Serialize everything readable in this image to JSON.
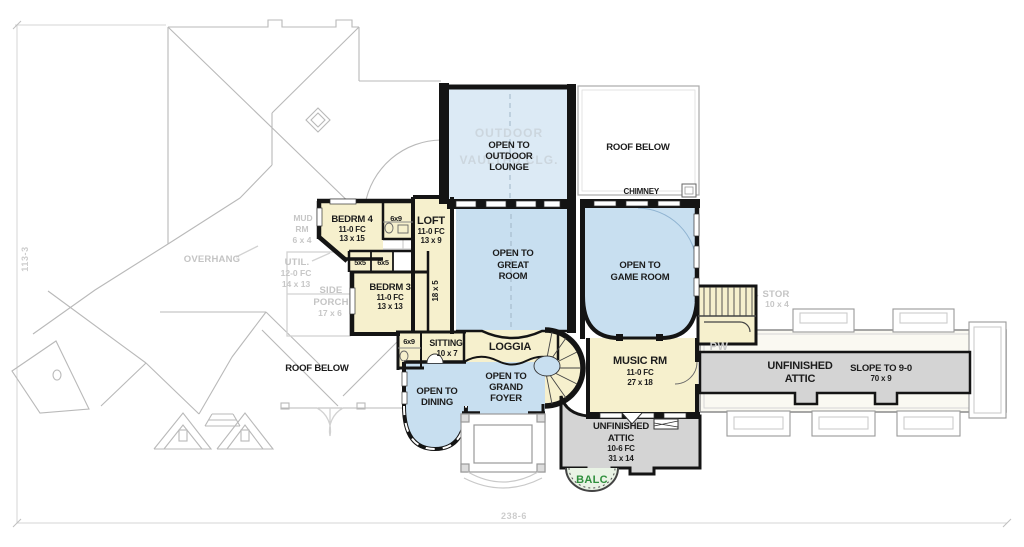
{
  "plan": {
    "dim_height": "113-3",
    "dim_width": "238-6",
    "watermark": {
      "l1": "OUTDOOR",
      "l2": "VAULTED CLG."
    },
    "open": {
      "lounge": {
        "l1": "OPEN TO",
        "l2": "OUTDOOR",
        "l3": "LOUNGE"
      },
      "great": {
        "l1": "OPEN TO",
        "l2": "GREAT",
        "l3": "ROOM"
      },
      "game": {
        "l1": "OPEN TO",
        "l2": "GAME ROOM"
      },
      "dining": {
        "l1": "OPEN TO",
        "l2": "DINING"
      },
      "foyer": {
        "l1": "OPEN TO",
        "l2": "GRAND",
        "l3": "FOYER"
      }
    },
    "rooms": {
      "bedrm4": {
        "name": "BEDRM 4",
        "fc": "11-0 FC",
        "size": "13 x 15"
      },
      "loft": {
        "name": "LOFT",
        "fc": "11-0 FC",
        "size": "13 x 9"
      },
      "bedrm3": {
        "name": "BEDRM 3",
        "fc": "11-0 FC",
        "size": "13 x 13"
      },
      "sitting": {
        "name": "SITTING",
        "size": "10 x 7"
      },
      "loggia": {
        "name": "LOGGIA"
      },
      "music": {
        "name": "MUSIC RM",
        "fc": "11-0 FC",
        "size": "27 x 18"
      },
      "bath_a": {
        "size": "6x9"
      },
      "closet_a": {
        "size": "5x5"
      },
      "closet_b": {
        "size": "6x5"
      },
      "bath_b": {
        "size": "6x9"
      },
      "hall": {
        "size": "18 x 5"
      }
    },
    "roof": {
      "top": "ROOF BELOW",
      "chimney": "CHIMNEY",
      "left": "ROOF BELOW"
    },
    "attic": {
      "center": {
        "l1": "UNFINISHED",
        "l2": "ATTIC",
        "fc": "10-6 FC",
        "size": "31 x 14"
      },
      "wing": {
        "l1": "UNFINISHED",
        "l2": "ATTIC",
        "slope": "SLOPE TO 9-0",
        "size": "70 x 9"
      }
    },
    "ghost": {
      "mud": {
        "l1": "MUD",
        "l2": "RM",
        "size": "6 x 4"
      },
      "overhang": "OVERHANG",
      "util": {
        "l1": "UTIL.",
        "l2": "12-0 FC",
        "l3": "14 x 13"
      },
      "porch": {
        "l1": "SIDE",
        "l2": "PORCH",
        "size": "17 x 6"
      },
      "stor": {
        "l1": "STOR",
        "size": "10 x 4"
      },
      "pw": "PW"
    },
    "balc": "BALC",
    "colors": {
      "room_cream": "#F6F0CD",
      "open_blue": "#C8DFF0",
      "lounge_blue": "#DCEAF5",
      "attic_gray": "#D4D4D4",
      "wall_black": "#141414",
      "ghost_gray": "#C4C4C4",
      "balc_green": "#2F8F3C"
    }
  }
}
